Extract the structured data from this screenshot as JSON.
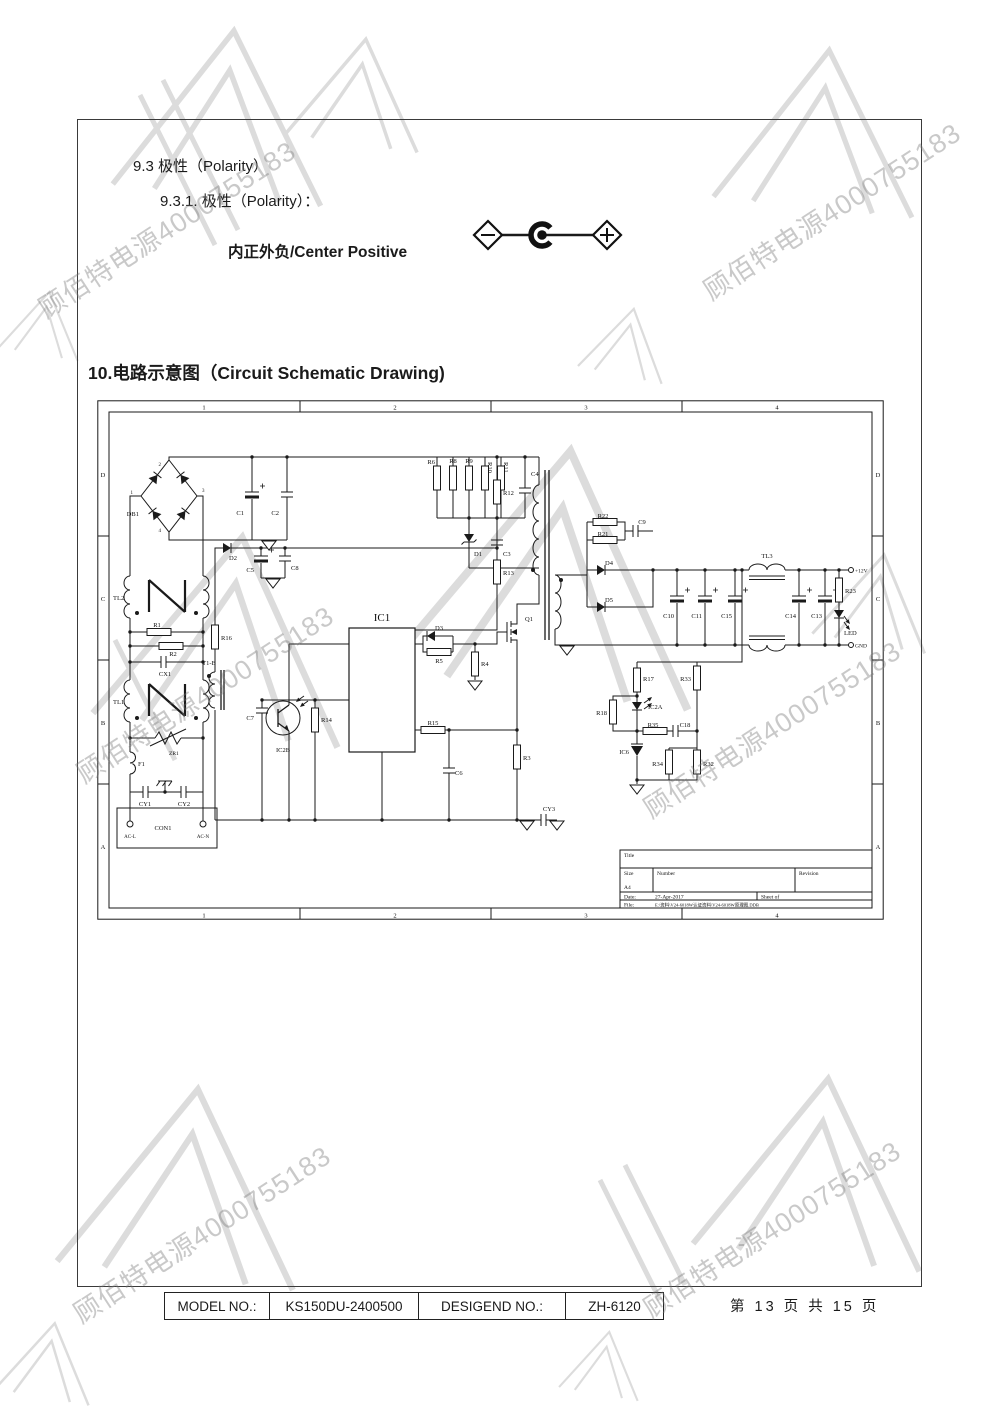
{
  "page": {
    "section_9_3": "9.3 极性（Polarity）",
    "section_9_3_1": "9.3.1.  极性（Polarity）：",
    "polarity_text": "内正外负/Center Positive",
    "section_10_title": "10.电路示意图（Circuit Schematic Drawing)"
  },
  "watermark": {
    "text": "顾佰特电源4000755183"
  },
  "schematic": {
    "cols": [
      "1",
      "2",
      "3",
      "4"
    ],
    "rows": [
      "D",
      "C",
      "B",
      "A"
    ],
    "bridge_pins": {
      "p1": "1",
      "p2": "2",
      "p3": "3",
      "p4": "4"
    },
    "labels": {
      "DB1": "DB1",
      "C1": "C1",
      "C2": "C2",
      "R6": "R6",
      "R8": "R8",
      "R9": "R9",
      "R10": "R10",
      "R11": "R11",
      "C4": "C4",
      "D1": "D1",
      "C3": "C3",
      "R12": "R12",
      "R13": "R13",
      "D2": "D2",
      "C5": "C5",
      "C8": "C8",
      "R16": "R16",
      "T1B": "T1-B",
      "C7": "C7",
      "IC2B": "IC2B",
      "R14": "R14",
      "IC1": "IC1",
      "TL2": "TL2",
      "R1": "R1",
      "R2": "R2",
      "CX1": "CX1",
      "TL1": "TL1",
      "ZR1": "ZR1",
      "F1": "F1",
      "CY1": "CY1",
      "CY2": "CY2",
      "CON1": "CON1",
      "ACL": "AC-L",
      "ACN": "AC-N",
      "D3": "D3",
      "R5": "R5",
      "R4": "R4",
      "Q1": "Q1",
      "R15": "R15",
      "C6": "C6",
      "R3": "R3",
      "CY3": "CY3",
      "R22": "R22",
      "R21": "R21",
      "C9": "C9",
      "D4": "D4",
      "D5": "D5",
      "C10": "C10",
      "C11": "C11",
      "C15": "C15",
      "TL3": "TL3",
      "C14": "C14",
      "C13": "C13",
      "R23": "R23",
      "LED": "LED",
      "V12": "+12V",
      "GND": "GND",
      "R17": "R17",
      "R33": "R33",
      "R18": "R18",
      "IC2A": "IC2A",
      "R35": "R35",
      "C18": "C18",
      "IC6": "IC6",
      "R34": "R34",
      "R32": "R32"
    },
    "titleblock": {
      "title_label": "Title",
      "size_label": "Size",
      "size_value": "A4",
      "number_label": "Number",
      "revision_label": "Revision",
      "date_label": "Date:",
      "date_value": "27-Apr-2017",
      "sheet_label": "Sheet  of",
      "file_label": "File:",
      "file_value": "E:\\资料\\V24-6018W认证资料\\V24-6018W原理图.DDB"
    }
  },
  "footer": {
    "model_label": "MODEL NO.:",
    "model_value": "KS150DU-2400500",
    "design_label": "DESIGEND NO.:",
    "design_value": "ZH-6120",
    "page_text": "第 13 页 共 15 页"
  }
}
